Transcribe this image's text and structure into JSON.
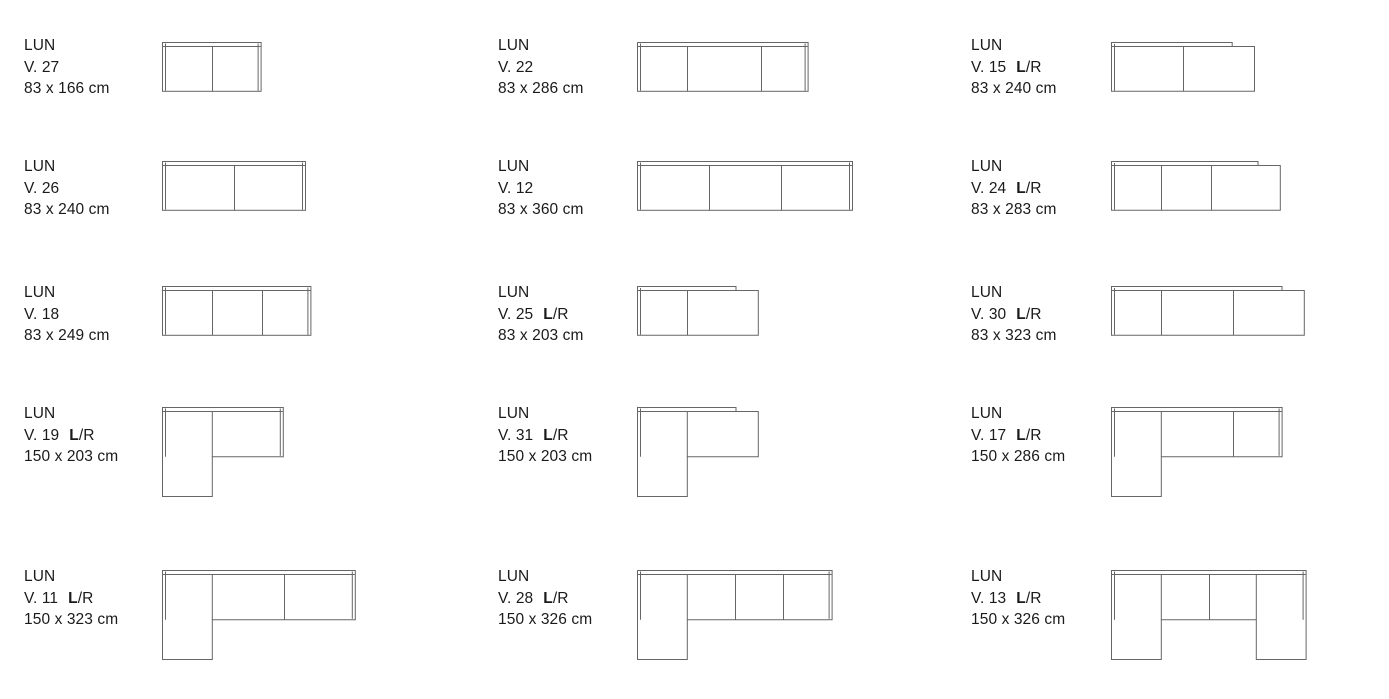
{
  "style": {
    "background": "#ffffff",
    "text_color": "#1a1a1a",
    "line_color": "#666666"
  },
  "catalog": {
    "model": "LUN",
    "unit": "cm",
    "cells": [
      {
        "variant": "V. 27",
        "lr_bold": "",
        "lr_rest": "",
        "dims": "83 x 166 cm",
        "row": 0,
        "col": 0,
        "plan": {
          "type": "linear",
          "width_cm": 166,
          "depth_cm": 83,
          "seat_dividers_cm": [
            83
          ],
          "open_end": false
        }
      },
      {
        "variant": "V. 22",
        "lr_bold": "",
        "lr_rest": "",
        "dims": "83 x 286 cm",
        "row": 0,
        "col": 1,
        "plan": {
          "type": "linear",
          "width_cm": 286,
          "depth_cm": 83,
          "seat_dividers_cm": [
            83,
            206
          ],
          "open_end": false
        }
      },
      {
        "variant": "V. 15",
        "lr_bold": "L",
        "lr_rest": "/R",
        "dims": "83 x 240 cm",
        "row": 0,
        "col": 2,
        "plan": {
          "type": "linear",
          "width_cm": 240,
          "depth_cm": 83,
          "seat_dividers_cm": [
            120
          ],
          "open_end": true
        }
      },
      {
        "variant": "V. 26",
        "lr_bold": "",
        "lr_rest": "",
        "dims": "83 x 240 cm",
        "row": 1,
        "col": 0,
        "plan": {
          "type": "linear",
          "width_cm": 240,
          "depth_cm": 83,
          "seat_dividers_cm": [
            120
          ],
          "open_end": false
        }
      },
      {
        "variant": "V. 12",
        "lr_bold": "",
        "lr_rest": "",
        "dims": "83 x 360 cm",
        "row": 1,
        "col": 1,
        "plan": {
          "type": "linear",
          "width_cm": 360,
          "depth_cm": 83,
          "seat_dividers_cm": [
            120,
            240
          ],
          "open_end": false
        }
      },
      {
        "variant": "V. 24",
        "lr_bold": "L",
        "lr_rest": "/R",
        "dims": "83 x 283 cm",
        "row": 1,
        "col": 2,
        "plan": {
          "type": "linear",
          "width_cm": 283,
          "depth_cm": 83,
          "seat_dividers_cm": [
            83,
            166
          ],
          "open_end": true
        }
      },
      {
        "variant": "V. 18",
        "lr_bold": "",
        "lr_rest": "",
        "dims": "83 x 249 cm",
        "row": 2,
        "col": 0,
        "plan": {
          "type": "linear",
          "width_cm": 249,
          "depth_cm": 83,
          "seat_dividers_cm": [
            83,
            166
          ],
          "open_end": false
        }
      },
      {
        "variant": "V. 25",
        "lr_bold": "L",
        "lr_rest": "/R",
        "dims": "83 x 203 cm",
        "row": 2,
        "col": 1,
        "plan": {
          "type": "linear",
          "width_cm": 203,
          "depth_cm": 83,
          "seat_dividers_cm": [
            83
          ],
          "open_end": true
        }
      },
      {
        "variant": "V. 30",
        "lr_bold": "L",
        "lr_rest": "/R",
        "dims": "83 x 323 cm",
        "row": 2,
        "col": 2,
        "plan": {
          "type": "linear",
          "width_cm": 323,
          "depth_cm": 83,
          "seat_dividers_cm": [
            83,
            203
          ],
          "open_end": true
        }
      },
      {
        "variant": "V. 19",
        "lr_bold": "L",
        "lr_rest": "/R",
        "dims": "150 x 203 cm",
        "row": 3,
        "col": 0,
        "plan": {
          "type": "l-left",
          "width_cm": 203,
          "depth_cm": 150,
          "body_depth_cm": 83,
          "chaise_width_cm": 83,
          "seat_dividers_cm": [],
          "open_end": false
        }
      },
      {
        "variant": "V. 31",
        "lr_bold": "L",
        "lr_rest": "/R",
        "dims": "150 x 203 cm",
        "row": 3,
        "col": 1,
        "plan": {
          "type": "l-left",
          "width_cm": 203,
          "depth_cm": 150,
          "body_depth_cm": 83,
          "chaise_width_cm": 83,
          "seat_dividers_cm": [],
          "open_end": true
        }
      },
      {
        "variant": "V. 17",
        "lr_bold": "L",
        "lr_rest": "/R",
        "dims": "150 x 286 cm",
        "row": 3,
        "col": 2,
        "plan": {
          "type": "l-left",
          "width_cm": 286,
          "depth_cm": 150,
          "body_depth_cm": 83,
          "chaise_width_cm": 83,
          "seat_dividers_cm": [
            203
          ],
          "open_end": false
        }
      },
      {
        "variant": "V. 11",
        "lr_bold": "L",
        "lr_rest": "/R",
        "dims": "150 x 323 cm",
        "row": 4,
        "col": 0,
        "plan": {
          "type": "l-left",
          "width_cm": 323,
          "depth_cm": 150,
          "body_depth_cm": 83,
          "chaise_width_cm": 83,
          "seat_dividers_cm": [
            203
          ],
          "open_end": false
        }
      },
      {
        "variant": "V. 28",
        "lr_bold": "L",
        "lr_rest": "/R",
        "dims": "150 x 326 cm",
        "row": 4,
        "col": 1,
        "plan": {
          "type": "l-left",
          "width_cm": 326,
          "depth_cm": 150,
          "body_depth_cm": 83,
          "chaise_width_cm": 83,
          "seat_dividers_cm": [
            163,
            243
          ],
          "open_end": false
        }
      },
      {
        "variant": "V. 13",
        "lr_bold": "L",
        "lr_rest": "/R",
        "dims": "150 x 326 cm",
        "row": 4,
        "col": 2,
        "plan": {
          "type": "u-shape",
          "width_cm": 326,
          "depth_cm": 150,
          "body_depth_cm": 83,
          "chaise_width_cm": 83,
          "seat_dividers_cm": [
            163
          ],
          "open_end": false
        }
      }
    ]
  }
}
